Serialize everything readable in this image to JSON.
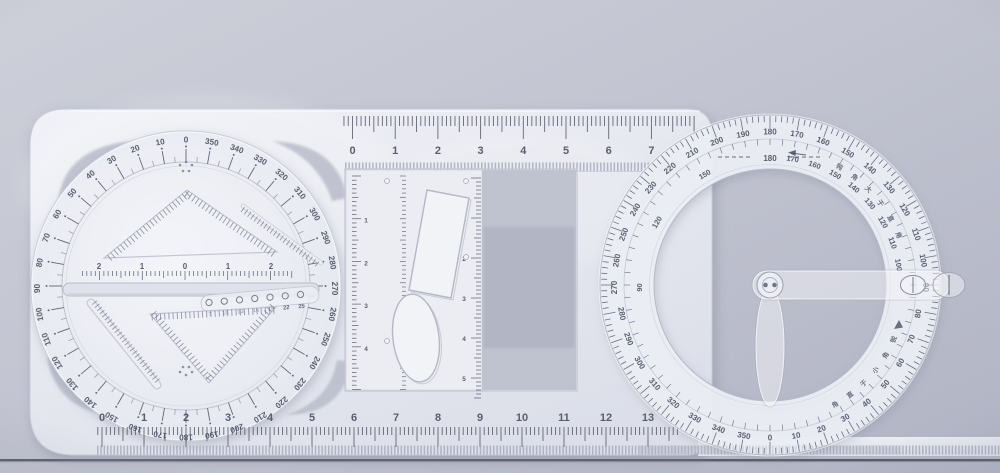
{
  "brand": {
    "text": "小太阳 CY-3306"
  },
  "top_ruler": {
    "unit_numbers": [
      "0",
      "1",
      "2",
      "3",
      "4",
      "5",
      "6",
      "7"
    ]
  },
  "bottom_ruler": {
    "unit_numbers": [
      "0",
      "1",
      "2",
      "3",
      "4",
      "5",
      "6",
      "7",
      "8",
      "9",
      "10",
      "11",
      "12",
      "13"
    ]
  },
  "dial": {
    "degree_numbers": [
      "0",
      "10",
      "20",
      "30",
      "40",
      "50",
      "60",
      "70",
      "80",
      "90",
      "100",
      "110",
      "120",
      "130",
      "140",
      "150",
      "160",
      "170",
      "180",
      "190",
      "200",
      "210",
      "220",
      "230",
      "240",
      "250",
      "260",
      "270",
      "280",
      "290",
      "300",
      "310",
      "320",
      "330",
      "340",
      "350"
    ],
    "slot_scale_numbers": [
      "2",
      "1",
      "0",
      "1",
      "2"
    ],
    "hole_diameter_numbers": [
      "7",
      "10",
      "13",
      "16",
      "19",
      "22",
      "25"
    ]
  },
  "insert": {
    "left_scale_numbers": [
      "1",
      "2",
      "3",
      "4"
    ],
    "right_scale_numbers": [
      "1",
      "2",
      "3",
      "4",
      "5"
    ]
  },
  "protractor": {
    "outer_degree_numbers": [
      "0",
      "10",
      "20",
      "30",
      "40",
      "50",
      "60",
      "70",
      "80",
      "90",
      "100",
      "110",
      "120",
      "130",
      "140",
      "150",
      "160",
      "170",
      "180",
      "190",
      "200",
      "210",
      "220",
      "230",
      "240",
      "250",
      "260",
      "270",
      "280",
      "290",
      "300",
      "310",
      "320",
      "330",
      "340",
      "350"
    ],
    "inner_top_number": "180",
    "inner_right_numbers": [
      "170",
      "160",
      "150",
      "140",
      "130",
      "120",
      "110",
      "100"
    ],
    "inner_left_numbers": [
      "150",
      "120",
      "90"
    ],
    "obtuse_label": "钝角大于直角",
    "acute_label": "锐角小于直角"
  },
  "colors": {
    "background_light": "#cdcfd9",
    "background_mid": "#c2c4d1",
    "background_dark": "#b1b4c4",
    "body_light": "#f1f2f7",
    "body_dark": "#dcdfe9",
    "cutout": "#b6b9c7",
    "cutout_deep": "#aeb1c0",
    "marking": "#4b5063",
    "marking_soft": "#7d8294",
    "edge": "#c2c5d3",
    "table_line": "#474a56",
    "brand_ink": "#333a4f"
  }
}
